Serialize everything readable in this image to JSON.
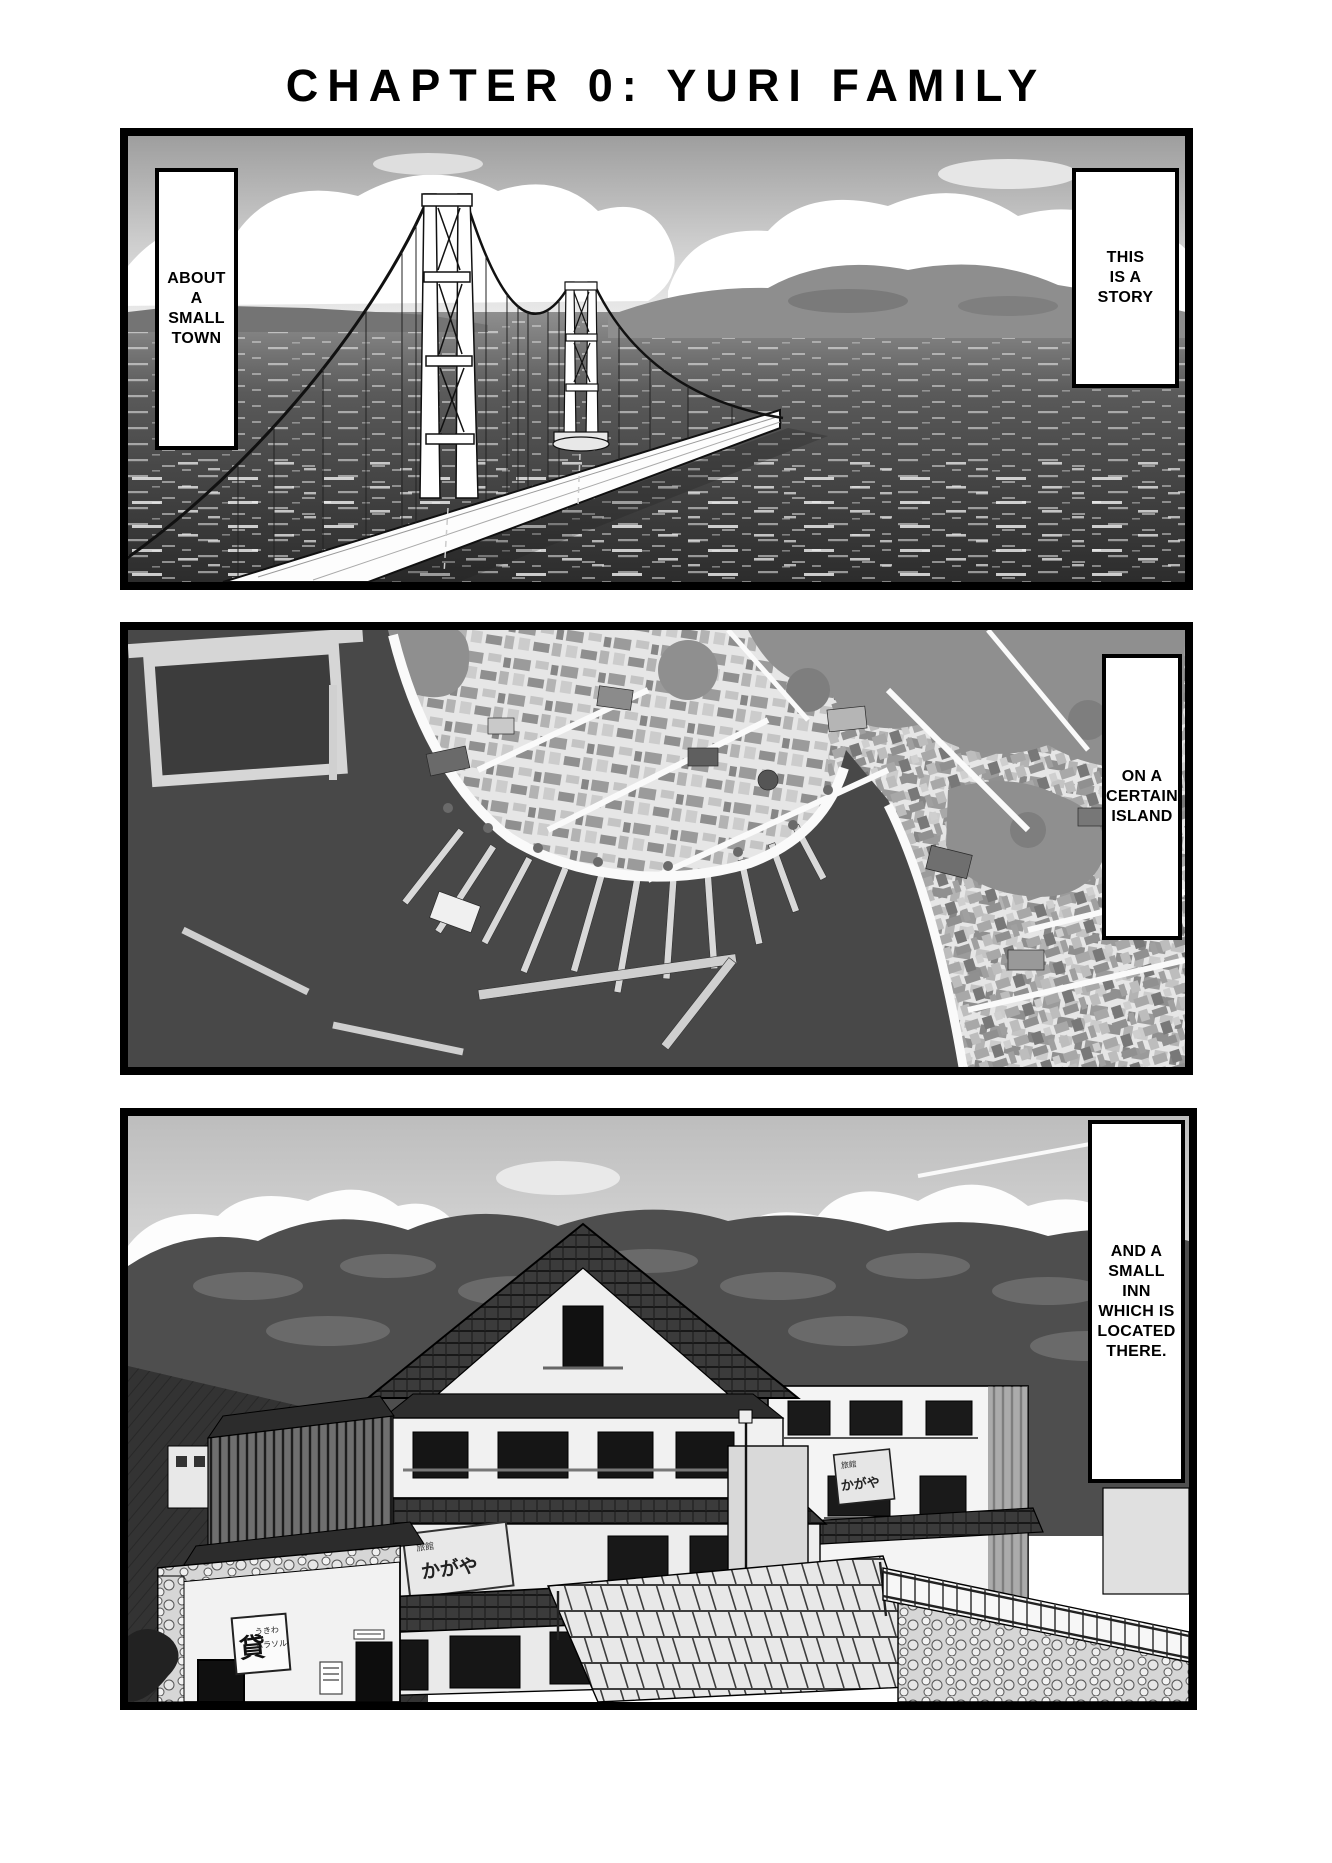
{
  "page": {
    "title": "CHAPTER 0: YURI FAMILY"
  },
  "captions": {
    "about_town": "ABOUT\nA\nSMALL\nTOWN",
    "this_is_a_story": "THIS\nIS A\nSTORY",
    "certain_island": "ON A\nCERTAIN\nISLAND",
    "small_inn": "AND A\nSMALL\nINN\nWHICH IS\nLOCATED\nTHERE."
  },
  "signs": {
    "inn_sign_label": "旅館",
    "inn_sign_name": "かがや",
    "inn_side_sign_label": "旅館",
    "inn_side_sign_name": "かがや",
    "rental_big": "貸",
    "rental_line1": "うきわ",
    "rental_line2": "パラソル"
  },
  "palette": {
    "ink": "#000000",
    "paper": "#ffffff",
    "sky_gray": "#a8a8a8",
    "sea_dark": "#343434",
    "water_dark": "#484848",
    "hill_dark": "#4e4e4e",
    "mid_gray": "#8f8f8f",
    "town_light": "#e6e6e6"
  }
}
